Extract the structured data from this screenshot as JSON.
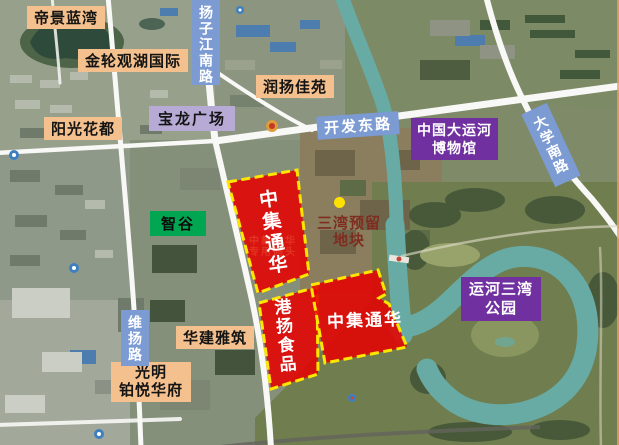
{
  "colors": {
    "label_orange_bg": "#F4C08D",
    "label_lavender_bg": "#B7ABD5",
    "road_label_blue_bg": "#7C9BD3",
    "label_purple_bg": "#7030A0",
    "label_green_bg": "#00A651",
    "site_fill_red": "#E60000",
    "site_border_yellow": "#FFE600",
    "reserve_dot_yellow": "#FFE100",
    "reserve_text_red": "#7E2D20",
    "water_teal": "#68ABA5",
    "road_white": "#F8F8F6"
  },
  "places": {
    "dijing_lanwan": "帝景蓝湾",
    "jinlun_guanhu": "金轮观湖国际",
    "yangguang_huadu": "阳光花都",
    "runyang_jiayuan": "润扬佳苑",
    "baolong_plaza": "宝龙广场",
    "zhigu": "智谷",
    "huajian_yazhu": "华建雅筑",
    "guangming_line1": "光明",
    "guangming_line2": "铂悦华府",
    "museum_line1": "中国大运河",
    "museum_line2": "博物馆",
    "yunhe_sanwan_line1": "运河三湾",
    "yunhe_sanwan_line2": "公园"
  },
  "roads": {
    "yangzijiang_south_rd": "扬子江南路",
    "kaifa_east_rd": "开发东路",
    "weiyang_rd": "维扬路",
    "daxue_south_rd": "大学南路"
  },
  "sites": {
    "zhongji_north": "中集通华",
    "gangyang_food": "港扬食品",
    "zhongji_east": "中集通华",
    "wharf_basemap_line1": "中集通华",
    "wharf_basemap_line2": "专用码头"
  },
  "reserve": {
    "line1": "三湾预留",
    "line2": "地块"
  }
}
